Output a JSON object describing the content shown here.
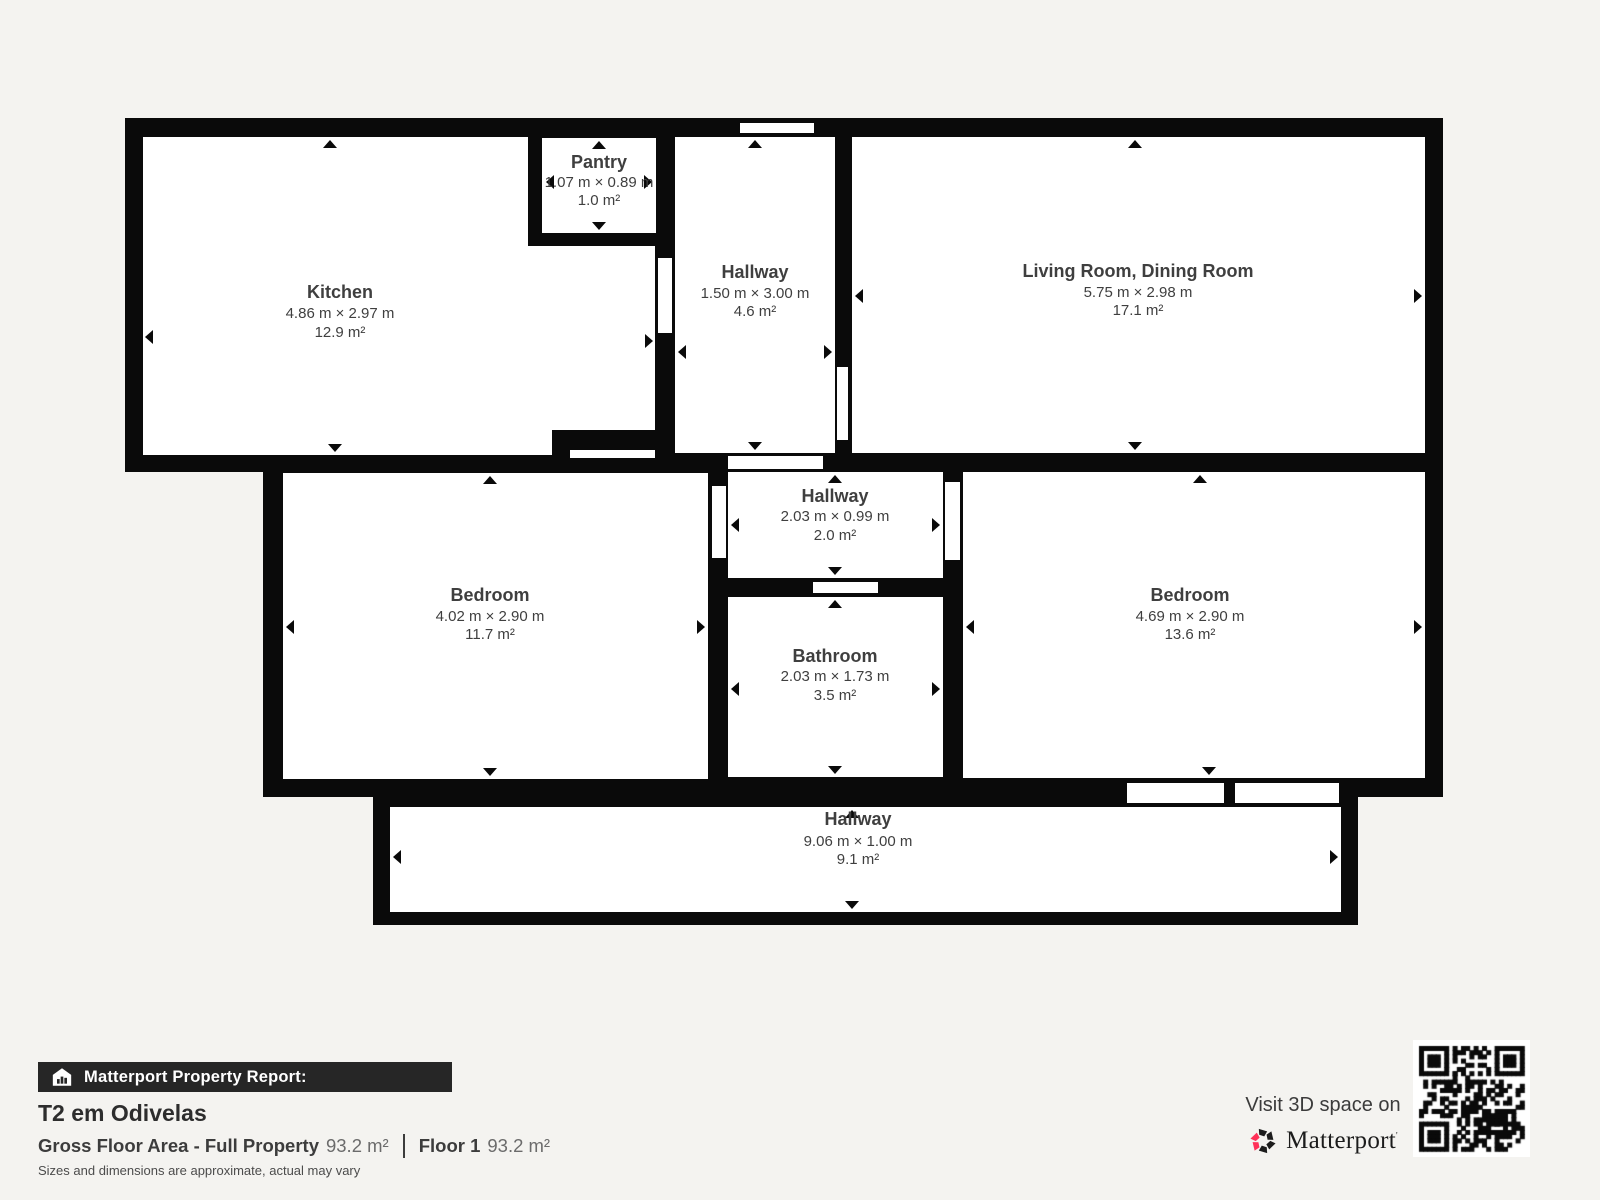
{
  "plan": {
    "rooms": [
      {
        "name": "Kitchen",
        "dims": "4.86 m × 2.97 m",
        "area": "12.9 m²"
      },
      {
        "name": "Pantry",
        "dims": "1.07 m × 0.89 m",
        "area": "1.0 m²"
      },
      {
        "name": "Hallway",
        "dims": "1.50 m × 3.00 m",
        "area": "4.6 m²"
      },
      {
        "name": "Living Room, Dining Room",
        "dims": "5.75 m × 2.98 m",
        "area": "17.1 m²"
      },
      {
        "name": "Hallway",
        "dims": "2.03 m × 0.99 m",
        "area": "2.0 m²"
      },
      {
        "name": "Bedroom",
        "dims": "4.02 m × 2.90 m",
        "area": "11.7 m²"
      },
      {
        "name": "Bathroom",
        "dims": "2.03 m × 1.73 m",
        "area": "3.5 m²"
      },
      {
        "name": "Bedroom",
        "dims": "4.69 m × 2.90 m",
        "area": "13.6 m²"
      },
      {
        "name": "Hallway",
        "dims": "9.06 m × 1.00 m",
        "area": "9.1 m²"
      }
    ]
  },
  "report": {
    "bar_label": "Matterport Property Report:",
    "property_title": "T2 em Odivelas",
    "gross_label": "Gross Floor Area - Full Property",
    "gross_value": "93.2 m²",
    "floor_label": "Floor 1",
    "floor_value": "93.2 m²",
    "disclaimer": "Sizes and dimensions are approximate, actual may vary"
  },
  "promo": {
    "visit_text": "Visit 3D space on",
    "brand": "Matterport"
  },
  "colors": {
    "wall": "#0a0a0a",
    "room_fill": "#ffffff",
    "page_bg": "#f4f3f0",
    "bar_bg": "#262626",
    "label_text": "#3f3f3f",
    "brand_red": "#ff3158"
  }
}
